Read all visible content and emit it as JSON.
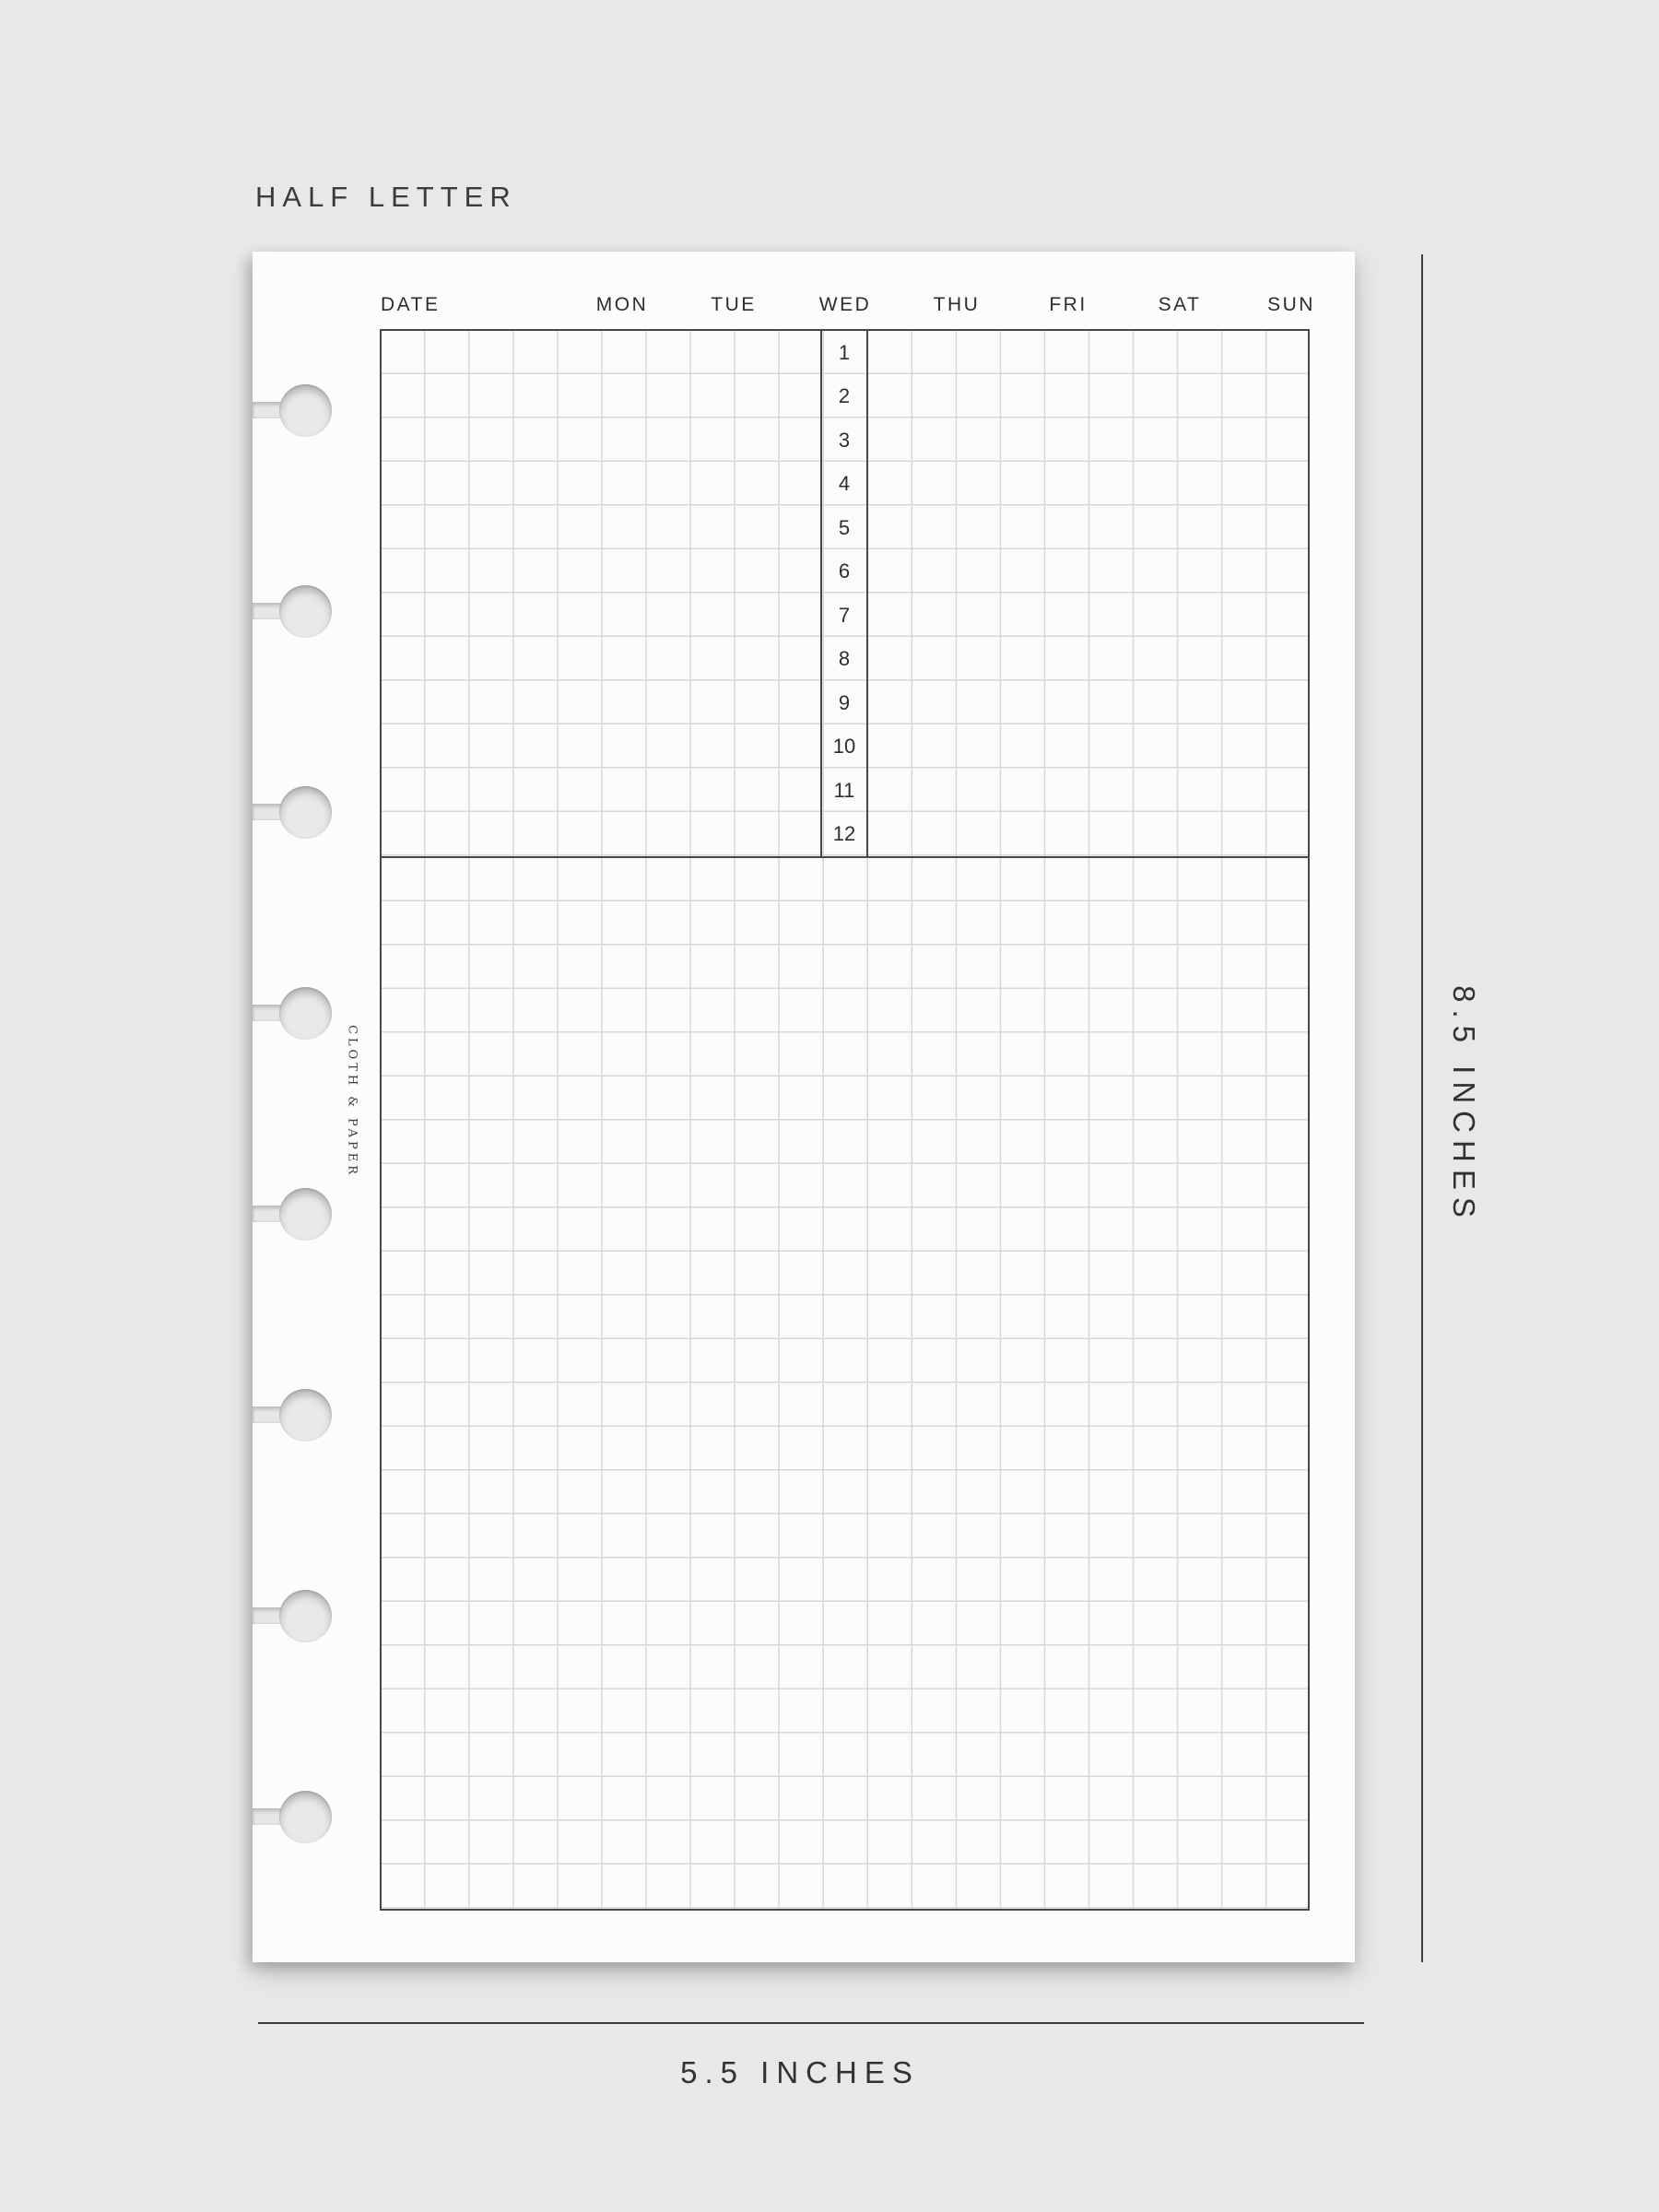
{
  "title": "HALF LETTER",
  "planner_page": {
    "brand": "CLOTH & PAPER",
    "date_label": "DATE",
    "day_headers": [
      "MON",
      "TUE",
      "WED",
      "THU",
      "FRI",
      "SAT",
      "SUN"
    ],
    "hours": [
      "1",
      "2",
      "3",
      "4",
      "5",
      "6",
      "7",
      "8",
      "9",
      "10",
      "11",
      "12"
    ],
    "binding_hole_count": 8
  },
  "measurements": {
    "height_label": "8.5 INCHES",
    "width_label": "5.5 INCHES"
  },
  "colors": {
    "background": "#e8e8e7",
    "page": "#fcfcfc",
    "grid_line": "#d7d7d7",
    "dark_border": "#474747",
    "text": "#323232"
  }
}
